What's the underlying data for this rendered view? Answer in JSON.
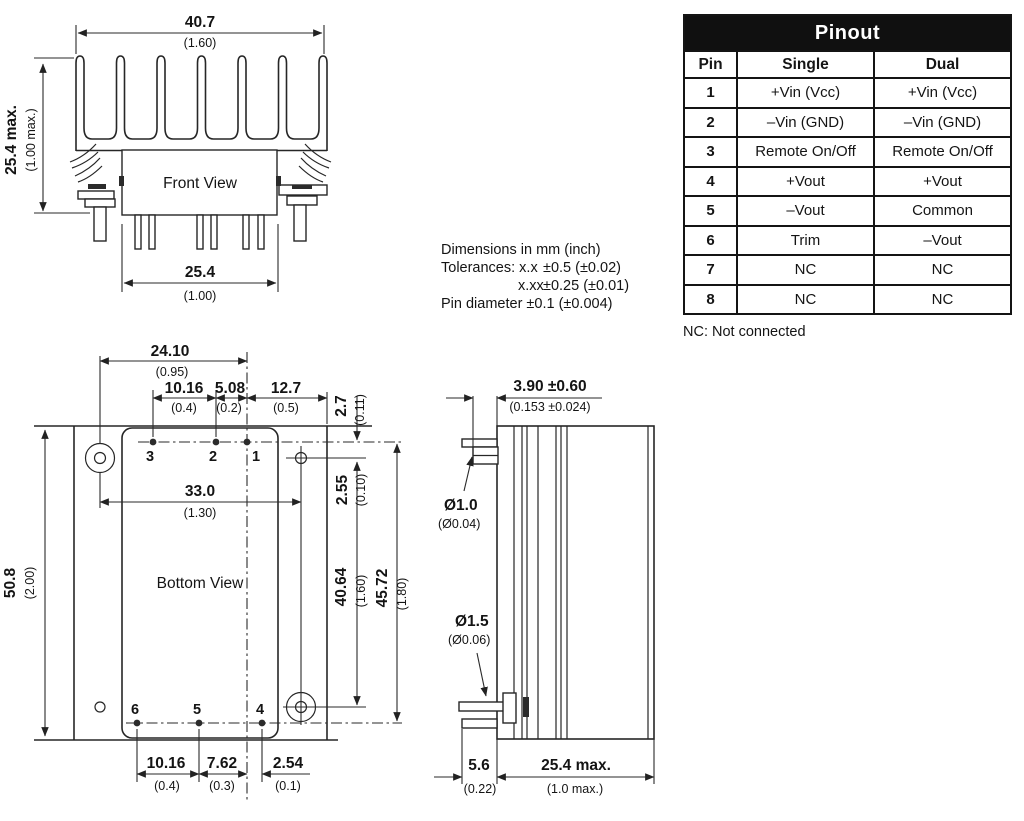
{
  "front_view": {
    "label": "Front View",
    "dim_width_mm": "40.7",
    "dim_width_in": "(1.60)",
    "dim_height_mm": "25.4 max.",
    "dim_height_in": "(1.00 max.)",
    "dim_body_mm": "25.4",
    "dim_body_in": "(1.00)"
  },
  "bottom_view": {
    "label": "Bottom View",
    "pin_labels_top": [
      "3",
      "2",
      "1"
    ],
    "pin_labels_bottom": [
      "6",
      "5",
      "4"
    ],
    "dim_24_10_mm": "24.10",
    "dim_24_10_in": "(0.95)",
    "dim_10_16_top_mm": "10.16",
    "dim_10_16_top_in": "(0.4)",
    "dim_5_08_mm": "5.08",
    "dim_5_08_in": "(0.2)",
    "dim_12_7_mm": "12.7",
    "dim_12_7_in": "(0.5)",
    "dim_2_7_mm": "2.7",
    "dim_2_7_in": "(0.11)",
    "dim_2_55_mm": "2.55",
    "dim_2_55_in": "(0.10)",
    "dim_33_0_mm": "33.0",
    "dim_33_0_in": "(1.30)",
    "dim_50_8_mm": "50.8",
    "dim_50_8_in": "(2.00)",
    "dim_40_64_mm": "40.64",
    "dim_40_64_in": "(1.60)",
    "dim_45_72_mm": "45.72",
    "dim_45_72_in": "(1.80)",
    "dim_10_16_bot_mm": "10.16",
    "dim_10_16_bot_in": "(0.4)",
    "dim_7_62_mm": "7.62",
    "dim_7_62_in": "(0.3)",
    "dim_2_54_mm": "2.54",
    "dim_2_54_in": "(0.1)"
  },
  "side_view": {
    "dim_standoff_mm": "3.90 ±0.60",
    "dim_standoff_in": "(0.153 ±0.024)",
    "dim_pin_dia_small_mm": "Ø1.0",
    "dim_pin_dia_small_in": "(Ø0.04)",
    "dim_pin_dia_large_mm": "Ø1.5",
    "dim_pin_dia_large_in": "(Ø0.06)",
    "dim_5_6_mm": "5.6",
    "dim_5_6_in": "(0.22)",
    "dim_25_4_mm": "25.4 max.",
    "dim_25_4_in": "(1.0 max.)"
  },
  "notes": {
    "line1": "Dimensions in mm (inch)",
    "tolerances_label": "Tolerances: x.x",
    "tolerance1": "±0.5 (±0.02)",
    "tolerance2_label": "x.xx",
    "tolerance2": "±0.25 (±0.01)",
    "pin_note": "Pin diameter ±0.1 (±0.004)"
  },
  "pinout": {
    "title": "Pinout",
    "columns": [
      "Pin",
      "Single",
      "Dual"
    ],
    "rows": [
      {
        "pin": "1",
        "single": "+Vin (Vcc)",
        "dual": "+Vin (Vcc)"
      },
      {
        "pin": "2",
        "single": "–Vin (GND)",
        "dual": "–Vin (GND)"
      },
      {
        "pin": "3",
        "single": "Remote On/Off",
        "dual": "Remote On/Off"
      },
      {
        "pin": "4",
        "single": "+Vout",
        "dual": "+Vout"
      },
      {
        "pin": "5",
        "single": "–Vout",
        "dual": "Common"
      },
      {
        "pin": "6",
        "single": "Trim",
        "dual": "–Vout"
      },
      {
        "pin": "7",
        "single": "NC",
        "dual": "NC"
      },
      {
        "pin": "8",
        "single": "NC",
        "dual": "NC"
      }
    ],
    "footnote": "NC: Not connected"
  }
}
